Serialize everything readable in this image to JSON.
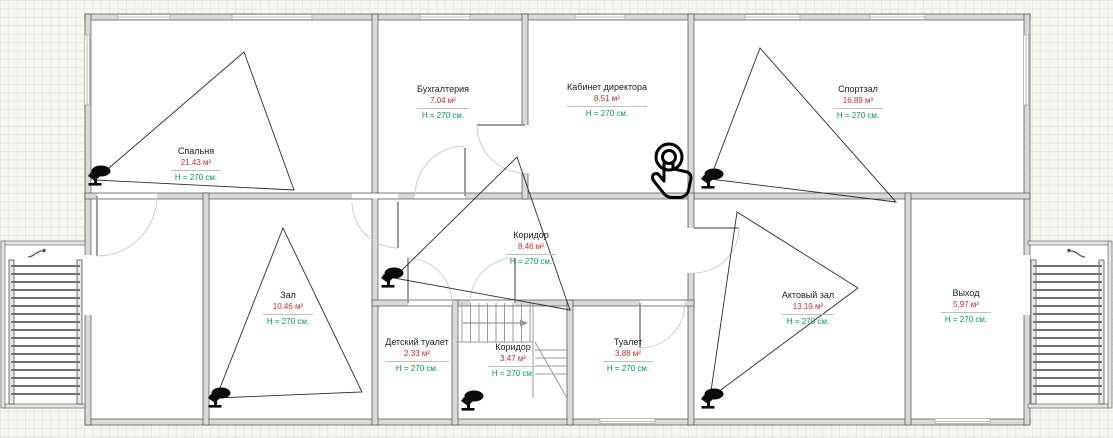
{
  "colors": {
    "background": "#f7f7f2",
    "grid_line": "#e8e8e1",
    "wall_fill": "#d9d9d9",
    "wall_stroke": "#4f4f4f",
    "area_text": "#d02b2b",
    "height_text": "#00a04a",
    "fov_stroke": "#2b2b2b",
    "door_leaf": "#9c9c9c",
    "door_arc": "#cfcfcf",
    "room_name_text": "#1c1c1c"
  },
  "rooms": [
    {
      "name": "Спальня",
      "area": "21.43 м²",
      "height": "H = 270 см."
    },
    {
      "name": "Бухгалтерия",
      "area": "7.04 м²",
      "height": "H = 270 см."
    },
    {
      "name": "Кабинет директора",
      "area": "8.51 м²",
      "height": "H = 270 см."
    },
    {
      "name": "Спортзал",
      "area": "16.89 м²",
      "height": "H = 270 см."
    },
    {
      "name": "Коридор",
      "area": "8.46 м²",
      "height": "H = 270 см."
    },
    {
      "name": "Зал",
      "area": "10.46 м²",
      "height": "H = 270 см."
    },
    {
      "name": "Детский туалет",
      "area": "2.33 м²",
      "height": "H = 270 см."
    },
    {
      "name": "Коридор",
      "area": "3.47 м²",
      "height": "H = 270 см."
    },
    {
      "name": "Туалет",
      "area": "3.88 м²",
      "height": "H = 270 см."
    },
    {
      "name": "Актовый зал",
      "area": "13.19 м²",
      "height": "H = 270 см."
    },
    {
      "name": "Выход",
      "area": "5.97 м²",
      "height": "H = 270 см."
    }
  ],
  "devices": {
    "camera_count": 6,
    "tap_marker_count": 1,
    "ladder_count": 2
  },
  "icons": {
    "camera": "cctv-camera-icon",
    "tap": "tap-gesture-icon",
    "ladder": "ladder-icon",
    "stairs_arrow": "stairs-direction-arrow"
  }
}
